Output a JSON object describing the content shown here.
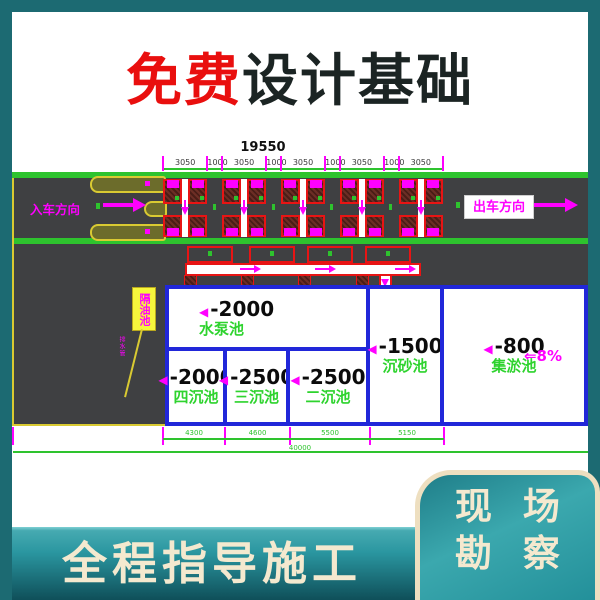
{
  "title": {
    "highlight": "免费",
    "rest": "设计基础"
  },
  "banner": {
    "text": "全程指导施工"
  },
  "corner_panel": {
    "line1": "现 场",
    "line2": "勘 察"
  },
  "drawing": {
    "top_dim": {
      "total": "19550",
      "segments": [
        "3050",
        "1000",
        "3050",
        "1000",
        "3050",
        "1000",
        "3050",
        "1000",
        "3050"
      ]
    },
    "entry_label": "入车方向",
    "exit_label": "出车方向",
    "callout_box": "隔油池",
    "pipe_note": "排水管",
    "pools": [
      {
        "id": "pump",
        "depth": "-2000",
        "name": "水泵池"
      },
      {
        "id": "four",
        "depth": "-2000",
        "name": "四沉池"
      },
      {
        "id": "three",
        "depth": "-2500",
        "name": "三沉池"
      },
      {
        "id": "two",
        "depth": "-2500",
        "name": "二沉池"
      },
      {
        "id": "sand",
        "depth": "-1500",
        "name": "沉砂池"
      },
      {
        "id": "mud",
        "depth": "-800",
        "name": "集淤池",
        "slope": "⇐8%"
      }
    ],
    "bottom_dims": {
      "segments": [
        "4300",
        "4600",
        "5500",
        "5150"
      ],
      "overall": "40000"
    }
  },
  "colors": {
    "teal_frame": "#1c6a72",
    "band_top": "#46aab1",
    "band_bottom": "#0f4f59",
    "cream": "#f4e9cf",
    "title_red": "#e90f0e",
    "title_dark": "#1b2423",
    "road_gray": "#3f4042",
    "cad_green": "#2ec32e",
    "cad_magenta": "#ff00ff",
    "cad_red": "#e81414",
    "cad_blue": "#2127d9",
    "bay_dark": "#4a1d17",
    "bay_light": "#6d2e25",
    "cad_yellow": "#d9ca32",
    "label_green": "#2ed32e"
  }
}
